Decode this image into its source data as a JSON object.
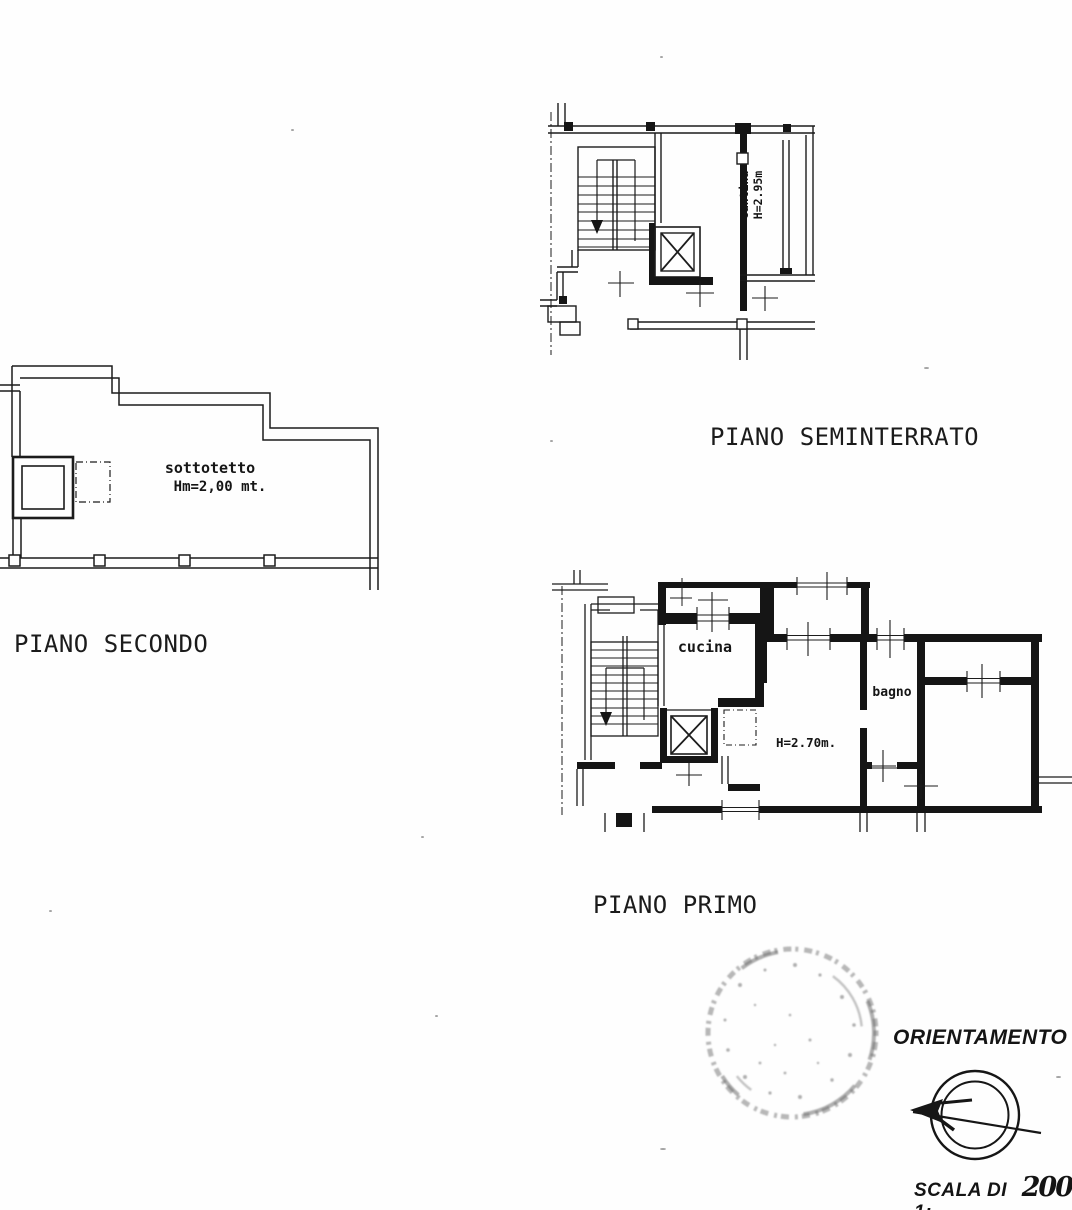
{
  "floors": [
    {
      "title": "PIANO SEMINTERRATO",
      "room": {
        "line1": "cantina",
        "line2": "H=2.95m"
      }
    },
    {
      "title": "PIANO SECONDO",
      "room": {
        "line1": "sottotetto",
        "line2": "Hm=2,00 mt."
      }
    },
    {
      "title": "PIANO PRIMO",
      "rooms": {
        "kitchen": "cucina",
        "bathroom": "bagno",
        "ceiling_height": "H=2.70m."
      }
    }
  ],
  "orientation_label": "ORIENTAMENTO",
  "scale": {
    "prefix": "SCALA DI 1:",
    "value": "200"
  },
  "colors": {
    "ink": "#151515",
    "stamp": "#6f6f6f"
  }
}
